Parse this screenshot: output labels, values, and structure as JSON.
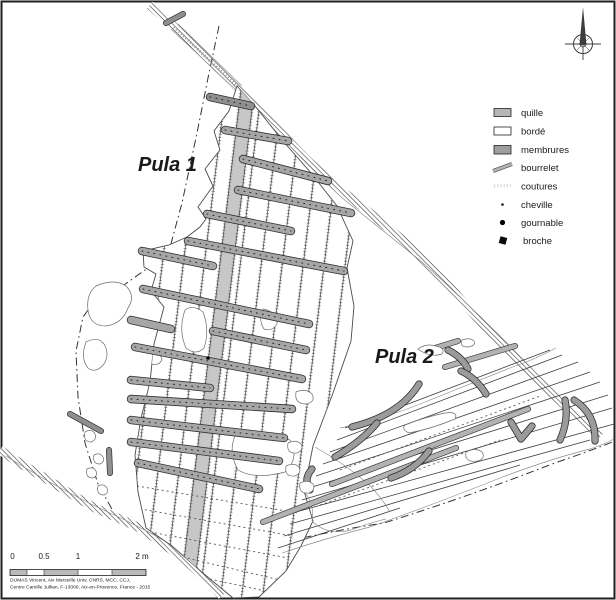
{
  "figure": {
    "wreck1_label": "Pula 1",
    "wreck2_label": "Pula 2"
  },
  "legend": {
    "items": [
      {
        "label": "quille",
        "color": "#b5b5b5"
      },
      {
        "label": "bordé",
        "color": "#ffffff"
      },
      {
        "label": "membrures",
        "color": "#9e9e9e"
      },
      {
        "label": "bourrelet",
        "color": "#b2b2b2"
      },
      {
        "label": "coutures",
        "color": "#d4d4d4"
      },
      {
        "label": "cheville",
        "color": "#1a1a1a"
      },
      {
        "label": "gournable",
        "color": "#000000"
      },
      {
        "label": "broche",
        "color": "#0a0a0a"
      }
    ]
  },
  "scalebar": {
    "labels": [
      "0",
      "0.5",
      "1",
      "2 m"
    ]
  },
  "credits": {
    "line1": "DUMAS Vincent, Aix Marseille Univ, CNRS, MCC, CCJ,",
    "line2": "Centre Camille Jullian, F-13000, Aix-en-Provence, France - 2015"
  },
  "icons": {
    "compass": "north-arrow"
  }
}
